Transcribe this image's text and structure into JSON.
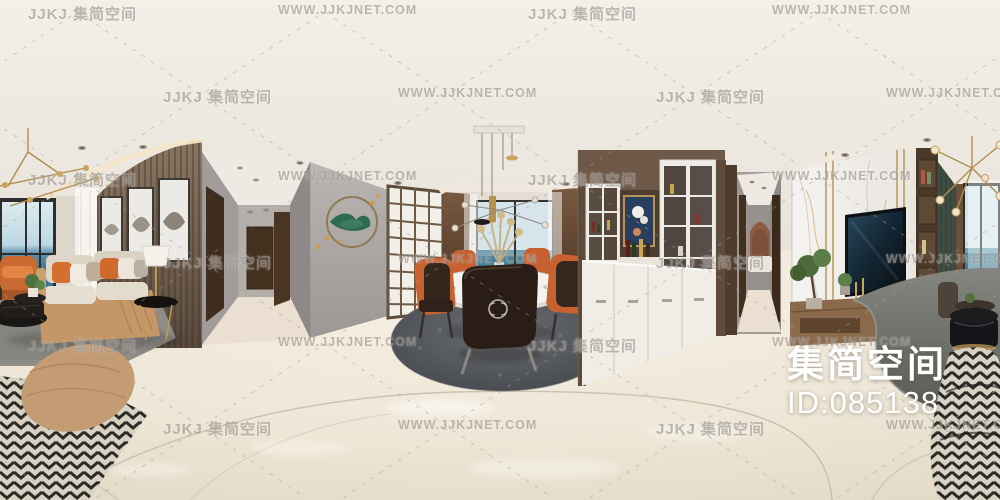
{
  "id_overlay": {
    "brand": "集简空间",
    "id": "ID:085138"
  },
  "watermarks": {
    "brand_text": "JJKJ 集简空间",
    "site_text": "WWW.JJKJNET.COM",
    "grid": {
      "row_start_y": 3,
      "row_step": 83,
      "rows": 6,
      "rows_a": [
        {
          "type": "brand",
          "x": 28
        },
        {
          "type": "site",
          "x": 278
        },
        {
          "type": "brand",
          "x": 528
        },
        {
          "type": "site",
          "x": 772
        }
      ],
      "rows_b": [
        {
          "type": "brand",
          "x": 163
        },
        {
          "type": "site",
          "x": 398
        },
        {
          "type": "brand",
          "x": 656
        },
        {
          "type": "site",
          "x": 886
        }
      ]
    }
  },
  "palette": {
    "ceiling": "#f0ece5",
    "floor": "#ece4d4",
    "wood_wall": "#6e5845",
    "accent_orange": "#cd6a32",
    "sea": "#44809b",
    "rug_gray": "#55585b",
    "carpet_gray": "#777976",
    "marble": "#f4f2ee",
    "green_panel": "#3f4d42",
    "id_text_color": "#ffffff",
    "watermark_color": "#96908a"
  }
}
